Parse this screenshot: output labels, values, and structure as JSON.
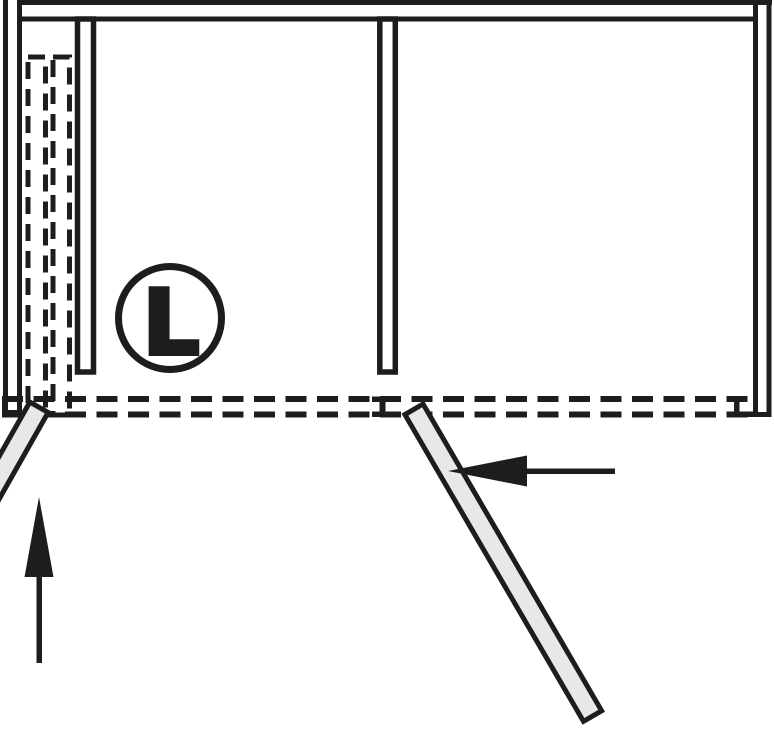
{
  "diagram": {
    "name": "folding-sliding-door-cabinet-top-view",
    "orientation_badge": {
      "label": "L"
    },
    "colors": {
      "line": "#1d1d1b",
      "door_fill": "#e8e8e8",
      "background": "#ffffff"
    },
    "elements": {
      "open_doors": 2,
      "stowed_dashed_doors": 2,
      "arrows": [
        "up",
        "left"
      ]
    }
  }
}
